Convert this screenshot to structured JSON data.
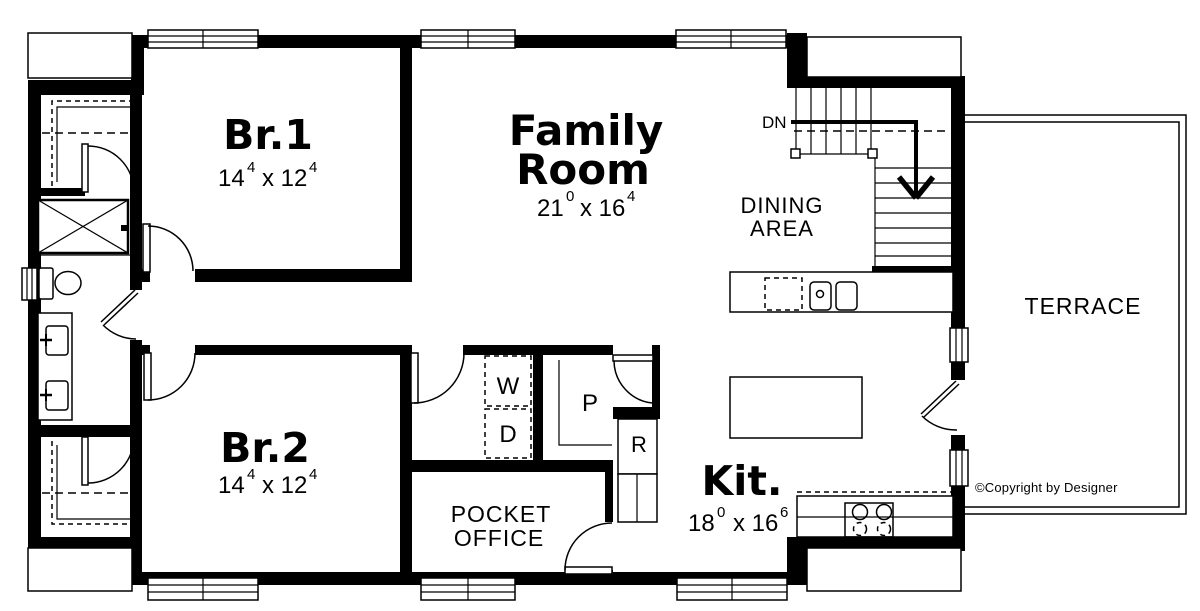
{
  "rooms": {
    "br1": {
      "name": "Br.1",
      "dim": {
        "w": "14",
        "w_sup": "4",
        "x": "x 12",
        "x_sup": "4"
      }
    },
    "family_room": {
      "name_line1": "Family",
      "name_line2": "Room",
      "dim": {
        "w": "21",
        "w_sup": "0",
        "x": "x 16",
        "x_sup": "4"
      }
    },
    "dining_area": {
      "name_line1": "DINING",
      "name_line2": "AREA"
    },
    "terrace": {
      "name": "TERRACE"
    },
    "br2": {
      "name": "Br.2",
      "dim": {
        "w": "14",
        "w_sup": "4",
        "x": "x 12",
        "x_sup": "4"
      }
    },
    "kitchen": {
      "name": "Kit.",
      "dim": {
        "w": "18",
        "w_sup": "0",
        "x": "x 16",
        "x_sup": "6"
      }
    },
    "pocket_office": {
      "name_line1": "POCKET",
      "name_line2": "OFFICE"
    }
  },
  "fixtures": {
    "washer": "W",
    "dryer": "D",
    "pantry": "P",
    "refrigerator": "R"
  },
  "stairs": {
    "direction_label": "DN"
  },
  "footer": {
    "copyright": "©Copyright by Designer"
  },
  "colors": {
    "line": "#000000",
    "background": "#ffffff"
  }
}
